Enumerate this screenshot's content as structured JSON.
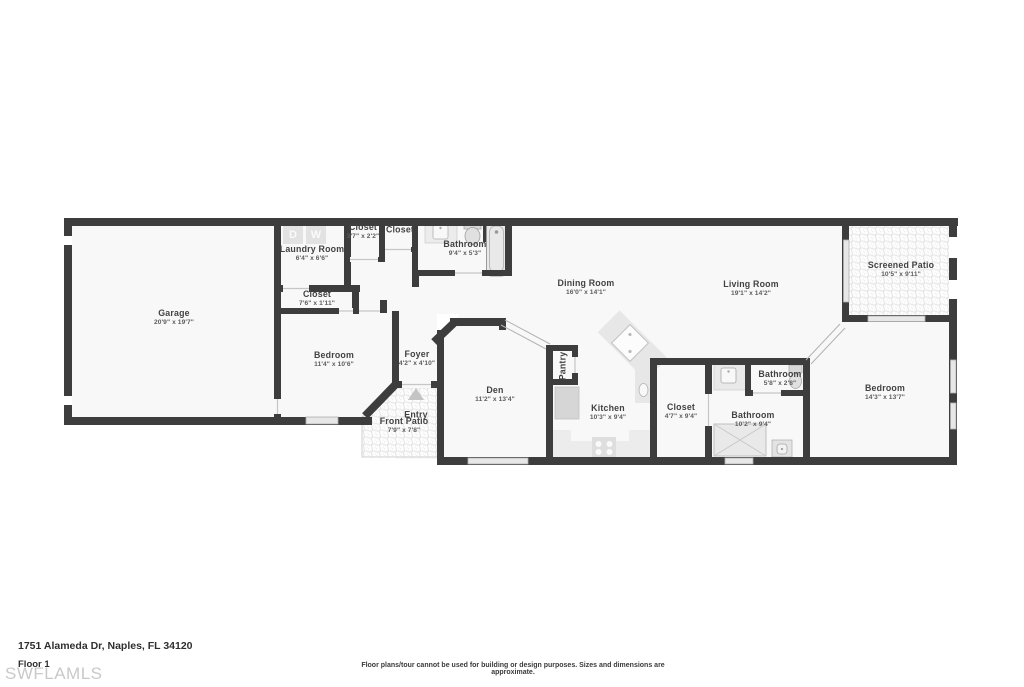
{
  "plan": {
    "rooms": [
      {
        "name": "Garage",
        "dims": "20'9\" x 19'7\""
      },
      {
        "name": "Laundry Room",
        "dims": "6'4\" x 6'6\""
      },
      {
        "name": "Closet",
        "dims": "3'7\" x 2'2\""
      },
      {
        "name": "Closet",
        "dims": ""
      },
      {
        "name": "Bathroom",
        "dims": "9'4\" x 5'3\""
      },
      {
        "name": "Closet",
        "dims": "7'6\" x 1'11\""
      },
      {
        "name": "Bedroom",
        "dims": "11'4\" x 10'6\""
      },
      {
        "name": "Foyer",
        "dims": "4'2\" x 4'10\""
      },
      {
        "name": "Entry",
        "dims": ""
      },
      {
        "name": "Front Patio",
        "dims": "7'9\" x 7'8\""
      },
      {
        "name": "Den",
        "dims": "11'2\" x 13'4\""
      },
      {
        "name": "Pantry",
        "dims": ""
      },
      {
        "name": "Kitchen",
        "dims": "10'3\" x 9'4\""
      },
      {
        "name": "Dining Room",
        "dims": "16'0\" x 14'1\""
      },
      {
        "name": "Living Room",
        "dims": "19'1\" x 14'2\""
      },
      {
        "name": "Screened Patio",
        "dims": "10'5\" x 9'11\""
      },
      {
        "name": "Closet",
        "dims": "4'7\" x 9'4\""
      },
      {
        "name": "Bathroom",
        "dims": "5'8\" x 2'8\""
      },
      {
        "name": "Bathroom",
        "dims": "10'2\" x 9'4\""
      },
      {
        "name": "Bedroom",
        "dims": "14'3\" x 13'7\""
      }
    ],
    "appliances": {
      "dryer_label": "D",
      "washer_label": "W"
    }
  },
  "footer": {
    "address": "1751 Alameda Dr, Naples, FL 34120",
    "floor_label": "Floor 1",
    "watermark": "SWFLAMLS",
    "disclaimer": "Floor plans/tour cannot be used for building or design purposes. Sizes and dimensions are approximate."
  },
  "colors": {
    "wall": "#3d3d3d",
    "floor": "#f8f8f8",
    "fixture": "#e8e8e8",
    "pattern_dot": "#e0e0e0",
    "watermark_text": "#c9c9c9",
    "label_text": "#424242",
    "dims_text": "#5c5c5c"
  }
}
